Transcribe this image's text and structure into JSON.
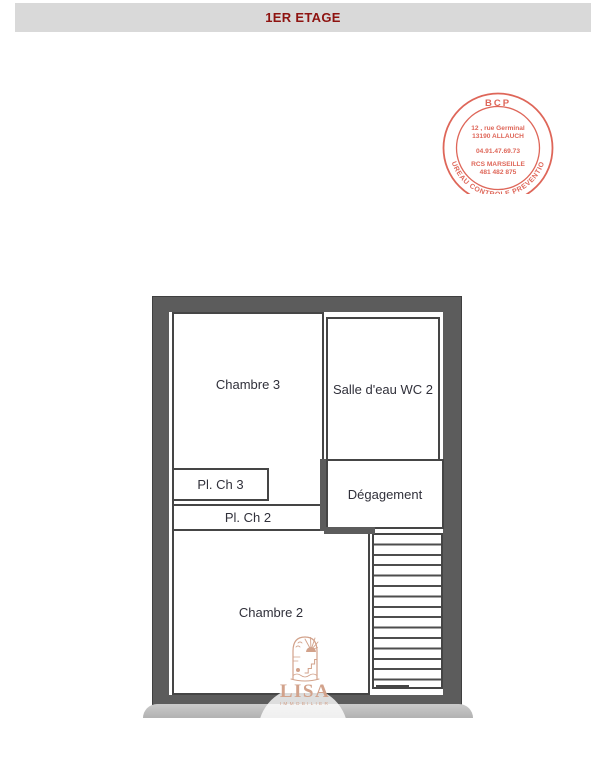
{
  "header": {
    "title": "1ER ETAGE",
    "bg_color": "#d9d9d9",
    "text_color": "#8e1310"
  },
  "stamp": {
    "color": "#dc5a4b",
    "top_text": "BCP",
    "address_line1": "12 , rue Germinal",
    "address_line2": "13190 ALLAUCH",
    "phone": "04.91.47.69.73",
    "rcs_line1": "RCS MARSEILLE",
    "rcs_line2": "481 482 875",
    "ring_text": "BUREAU CONTROLE PREVENTION"
  },
  "floorplan": {
    "wall_color": "#5c5c5c",
    "rooms": [
      {
        "id": "chambre-3",
        "label": "Chambre 3"
      },
      {
        "id": "salle-deau-wc-2",
        "label": "Salle d'eau WC 2"
      },
      {
        "id": "pl-ch-3",
        "label": "Pl. Ch 3"
      },
      {
        "id": "pl-ch-2",
        "label": "Pl. Ch 2"
      },
      {
        "id": "degagement",
        "label": "Dégagement"
      },
      {
        "id": "chambre-2",
        "label": "Chambre 2"
      }
    ]
  },
  "watermark": {
    "brand": "LISA",
    "subtitle": "IMMOBILIER",
    "color": "#d2a28b"
  }
}
